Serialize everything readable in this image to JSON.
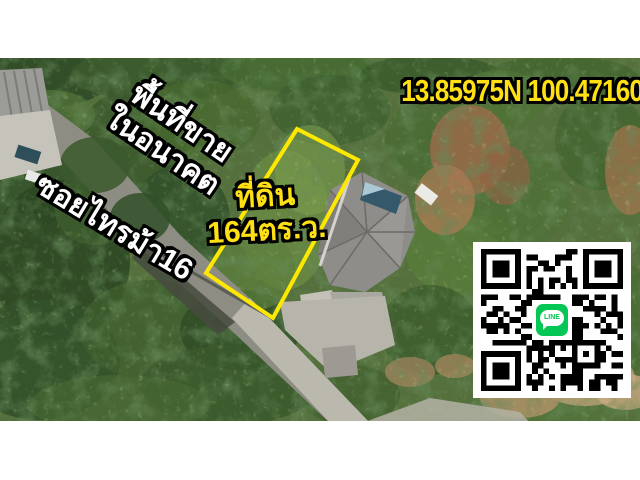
{
  "overlays": {
    "coordinates": "13.85975N 100.47160E",
    "sale_area": {
      "line1": "พื้นที่ขาย",
      "line2": "ในอนาคต"
    },
    "road_name": "ซอยไทรม้า16",
    "plot": {
      "line1": "ที่ดิน",
      "line2": "164ตร.ว."
    }
  },
  "qr": {
    "logo_text": "LINE"
  },
  "colors": {
    "highlight_yellow": "#ffe013",
    "plot_outline_yellow": "#ffe800",
    "text_white": "#ffffff",
    "text_outline": "#000000",
    "line_brand_green": "#06c755"
  }
}
